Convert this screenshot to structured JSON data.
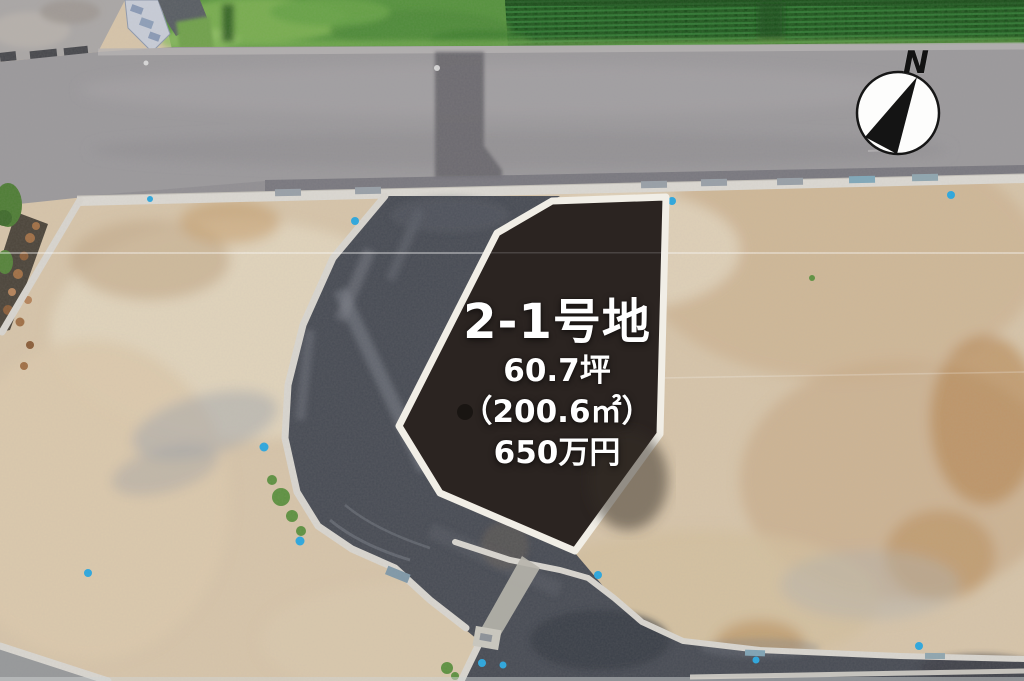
{
  "lot_annotation": {
    "name": "2-1号地",
    "area_tsubo": "60.7坪",
    "area_sqm": "（200.6㎡）",
    "price": "650万円"
  },
  "compass": {
    "north_label": "N"
  },
  "colors": {
    "lot_fill": "#2b2421",
    "lot_border": "#f1eee6",
    "label_text": "#ffffff",
    "marker_blue": "#2aa7df",
    "curb_white": "#d9d6d0",
    "asphalt_internal": "#474b54",
    "asphalt_main": "#9b999c",
    "field_green": "#55923d",
    "dirt_tan": "#d7c5aa"
  }
}
